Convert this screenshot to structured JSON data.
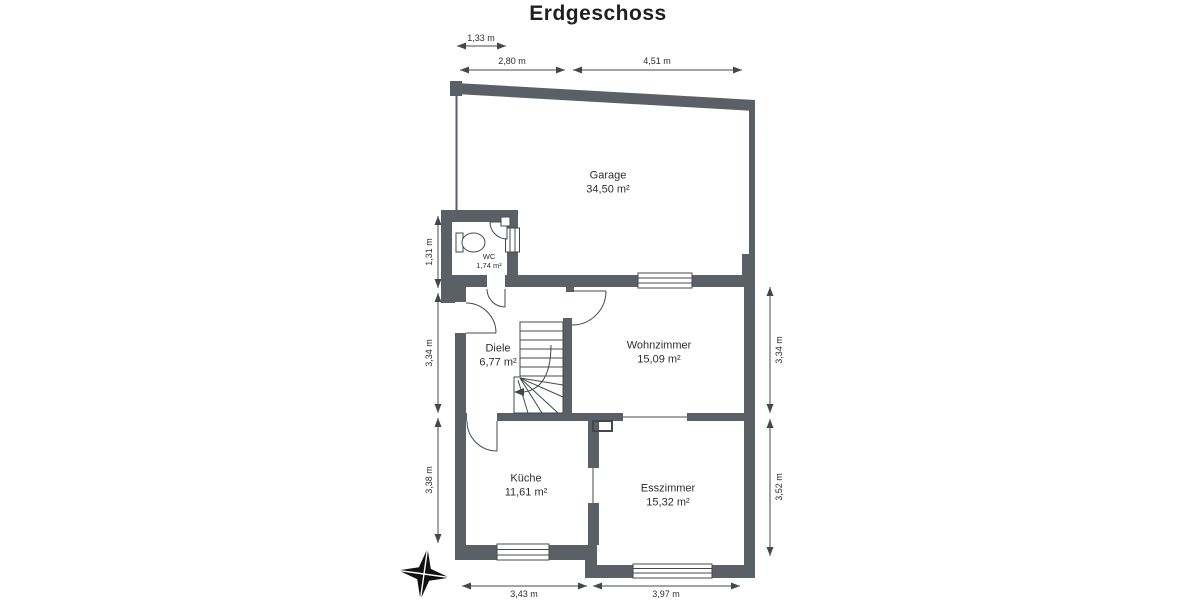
{
  "title": "Erdgeschoss",
  "rooms": {
    "garage": {
      "name": "Garage",
      "area": "34,50 m²"
    },
    "wc": {
      "name": "WC",
      "area": "1,74 m²"
    },
    "diele": {
      "name": "Diele",
      "area": "6,77 m²"
    },
    "wohnzimmer": {
      "name": "Wohnzimmer",
      "area": "15,09 m²"
    },
    "kueche": {
      "name": "Küche",
      "area": "11,61 m²"
    },
    "esszimmer": {
      "name": "Esszimmer",
      "area": "15,32 m²"
    }
  },
  "dimensions": {
    "top": [
      {
        "label": "1,33 m"
      },
      {
        "label": "2,80 m"
      },
      {
        "label": "4,51 m"
      }
    ],
    "left": [
      {
        "label": "1,31 m"
      },
      {
        "label": "3,34 m"
      },
      {
        "label": "3,38 m"
      }
    ],
    "right": [
      {
        "label": "3,34 m"
      },
      {
        "label": "3,52 m"
      }
    ],
    "bottom": [
      {
        "label": "3,43 m"
      },
      {
        "label": "3,97 m"
      }
    ]
  },
  "icons": {
    "compass": "compass-rose",
    "toilet": "toilet",
    "washbasin": "corner-washbasin",
    "stairs": "winder-staircase"
  },
  "colors": {
    "wall": "#5b6066",
    "line": "#44484e",
    "background": "#ffffff"
  }
}
